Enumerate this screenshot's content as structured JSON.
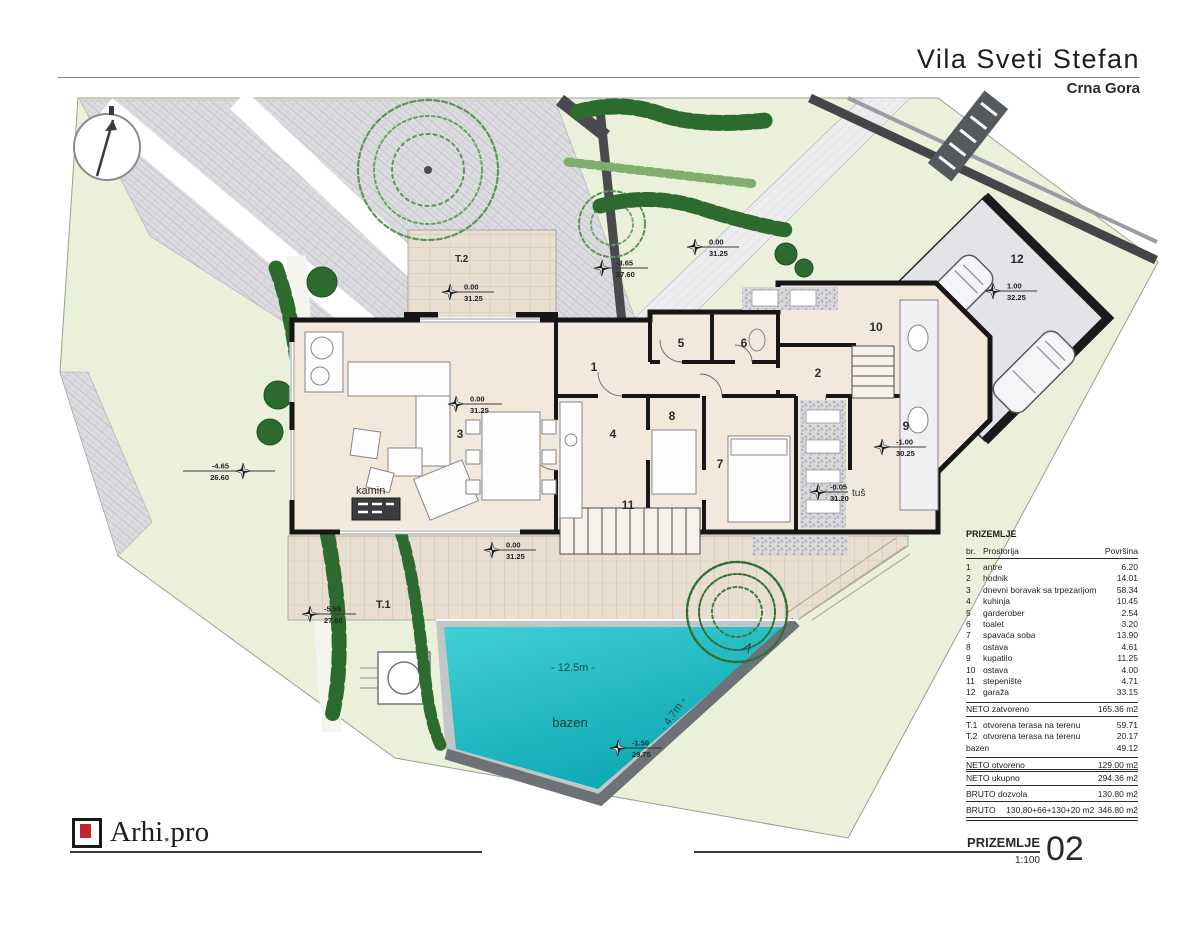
{
  "header": {
    "title": "Vila Sveti Stefan",
    "location": "Crna Gora"
  },
  "plan": {
    "labels": {
      "t2": "T.2",
      "t1": "T.1",
      "kamin": "kamin",
      "tus": "tuš",
      "bazen": "bazen",
      "pool_length": "- 12.5m -",
      "pool_width": "- 4.7m -"
    },
    "rooms": {
      "r1": "1",
      "r2": "2",
      "r3": "3",
      "r4": "4",
      "r5": "5",
      "r6": "6",
      "r7": "7",
      "r8": "8",
      "r9": "9",
      "r10": "10",
      "r11": "11",
      "r12": "12"
    },
    "markers": {
      "t2": {
        "top": "0.00",
        "bottom": "31.25"
      },
      "path": {
        "top": "0.00",
        "bottom": "31.25"
      },
      "ramp": {
        "top": "-3.65",
        "bottom": "27.60"
      },
      "living": {
        "top": "0.00",
        "bottom": "31.25"
      },
      "left": {
        "top": "-4.65",
        "bottom": "26.60"
      },
      "left_lower": {
        "top": "-5.55",
        "bottom": "27.60"
      },
      "t1": {
        "top": "0.00",
        "bottom": "31.25"
      },
      "garage": {
        "top": "1.00",
        "bottom": "32.25"
      },
      "room9": {
        "top": "-1.00",
        "bottom": "30.25"
      },
      "shower": {
        "top": "-0.05",
        "bottom": "31.20"
      },
      "pool": {
        "top": "-1.50",
        "bottom": "29.75"
      }
    }
  },
  "table": {
    "title": "PRIZEMLJE",
    "columns": {
      "num": "br.",
      "name": "Prostorija",
      "area": "Površina"
    },
    "rows": [
      {
        "num": "1",
        "name": "antre",
        "area": "6.20"
      },
      {
        "num": "2",
        "name": "hodnik",
        "area": "14.01"
      },
      {
        "num": "3",
        "name": "dnevni boravak sa trpezarijom",
        "area": "58.34"
      },
      {
        "num": "4",
        "name": "kuhinja",
        "area": "10.45"
      },
      {
        "num": "5",
        "name": "garderober",
        "area": "2.54"
      },
      {
        "num": "6",
        "name": "toalet",
        "area": "3.20"
      },
      {
        "num": "7",
        "name": "spavaća soba",
        "area": "13.90"
      },
      {
        "num": "8",
        "name": "ostava",
        "area": "4.61"
      },
      {
        "num": "9",
        "name": "kupatilo",
        "area": "11.25"
      },
      {
        "num": "10",
        "name": "ostava",
        "area": "4.00"
      },
      {
        "num": "11",
        "name": "stepenište",
        "area": "4.71"
      },
      {
        "num": "12",
        "name": "garaža",
        "area": "33.15"
      }
    ],
    "net_closed": {
      "label": "NETO zatvoreno",
      "value": "165.36 m2"
    },
    "open_rows": [
      {
        "num": "T.1",
        "name": "otvorena terasa na terenu",
        "area": "59.71"
      },
      {
        "num": "T.2",
        "name": "otvorena terasa na terenu",
        "area": "20.17"
      },
      {
        "num": "bazen",
        "name": "",
        "area": "49.12"
      }
    ],
    "net_open": {
      "label": "NETO otvoreno",
      "value": "129.00 m2"
    }
  },
  "summary": {
    "rows": [
      {
        "label": "NETO ukupno",
        "mid": "",
        "value": "294.36 m2"
      },
      {
        "label": "BRUTO dozvola",
        "mid": "",
        "value": "130.80 m2"
      },
      {
        "label": "BRUTO",
        "mid": "130.80+66+130+20 m2",
        "value": "346.80 m2"
      }
    ]
  },
  "footer": {
    "logo_pre": "Arhi",
    "logo_dot": ".",
    "logo_post": "pro",
    "sheet_title": "PRIZEMLJE",
    "scale": "1:100",
    "number": "02"
  }
}
